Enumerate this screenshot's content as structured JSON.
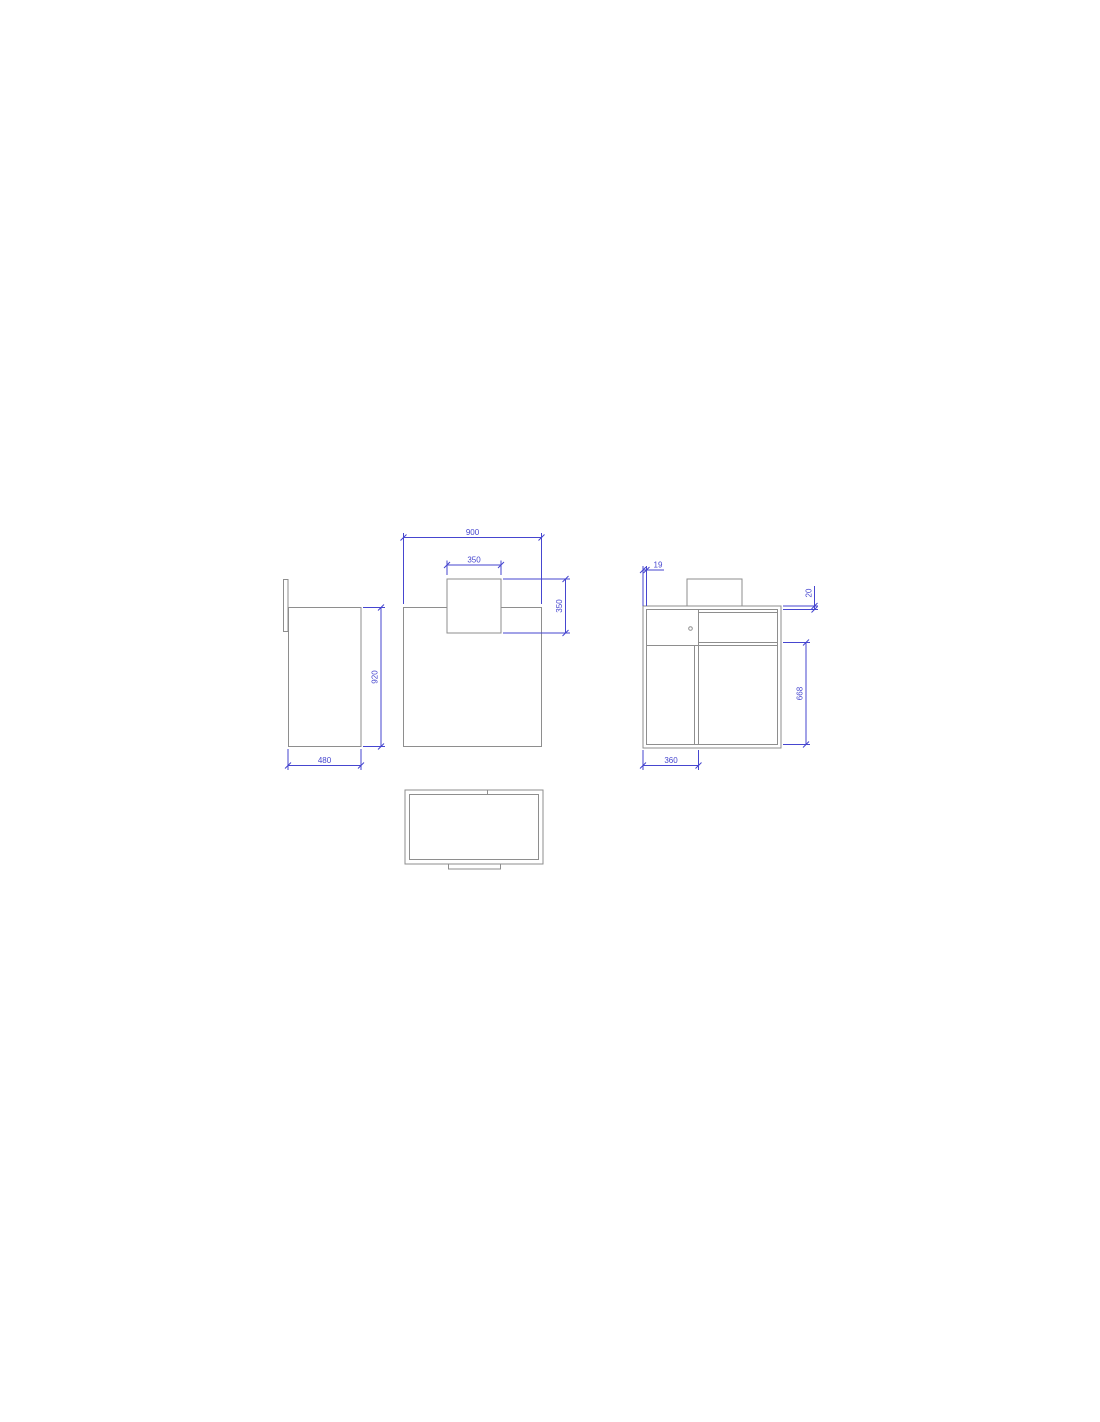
{
  "colors": {
    "background": "#ffffff",
    "line": "#8e8e8e",
    "dim": "#4646cf"
  },
  "drawing": {
    "type": "furniture-orthographic-technical-drawing",
    "views": [
      "side-view",
      "front-view",
      "detail-front-view",
      "plan-view"
    ]
  },
  "dimensions": {
    "side_height": "920",
    "side_depth": "480",
    "front_width": "900",
    "top_box_width": "350",
    "top_box_height": "350",
    "panel_thickness": "19",
    "countertop_thickness": "20",
    "door_section_height": "668",
    "left_module_width": "360"
  }
}
